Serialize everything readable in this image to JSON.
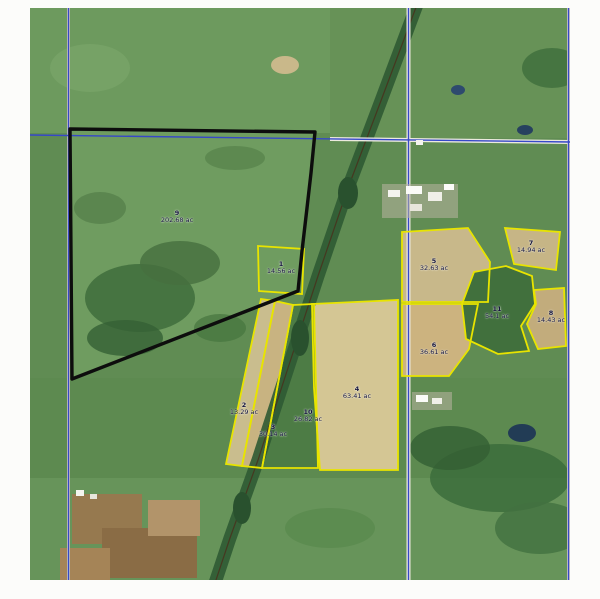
{
  "map": {
    "description": "aerial parcel map",
    "colors": {
      "parcel_outline": "#e8e400",
      "tract_outline": "#0d0d0d",
      "section_line": "#3648c8",
      "label_text": "#14143c"
    },
    "parcels": [
      {
        "num": "9",
        "acreage": "202.68 ac"
      },
      {
        "num": "1",
        "acreage": "14.56 ac"
      },
      {
        "num": "2",
        "acreage": "13.29 ac"
      },
      {
        "num": "3",
        "acreage": "30.14 ac"
      },
      {
        "num": "10",
        "acreage": "26.82 ac"
      },
      {
        "num": "4",
        "acreage": "63.41 ac"
      },
      {
        "num": "5",
        "acreage": "32.63 ac"
      },
      {
        "num": "6",
        "acreage": "36.61 ac"
      },
      {
        "num": "11",
        "acreage": "54.1 ac"
      },
      {
        "num": "7",
        "acreage": "14.94 ac"
      },
      {
        "num": "8",
        "acreage": "14.43 ac"
      }
    ]
  }
}
